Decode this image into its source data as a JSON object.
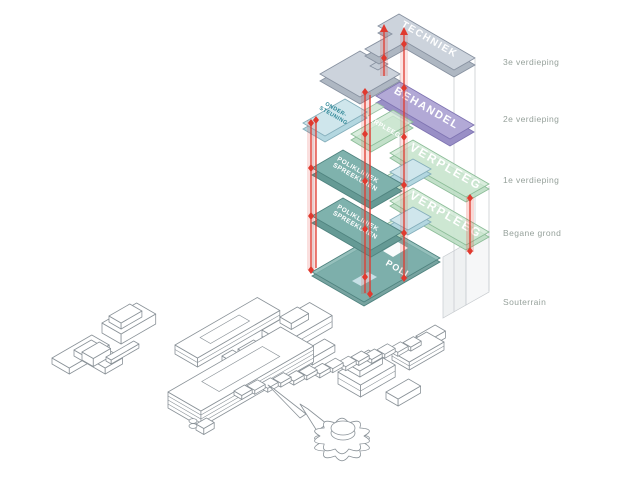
{
  "diagram": {
    "floor_labels": [
      "3e verdieping",
      "2e verdieping",
      "1e verdieping",
      "Begane grond",
      "Souterrain"
    ],
    "plates": {
      "techniek": "TECHNIEK",
      "behandel": "BEHANDEL",
      "ondersteuning_line1": "ONDER-",
      "ondersteuning_line2": "STEUNING",
      "verpleeg_2e": "VERPLEEG",
      "polikliniek_line1": "POLIKLINIEK",
      "polikliniek_line2": "SPREEKUREN",
      "verpleeg_1e": "VERPLEEG",
      "verpleeg_bg": "VERPLEEG",
      "poli": "POLI"
    },
    "colors": {
      "techniek": "#ccd3dc",
      "behandel": "#b2a9d6",
      "verpleeg": "#cfe8d4",
      "polikliniek": "#7fb2ad",
      "ondersteuning": "#cfe6ec",
      "circulation": "#e03a2f",
      "label_gray": "#96a19b"
    }
  }
}
